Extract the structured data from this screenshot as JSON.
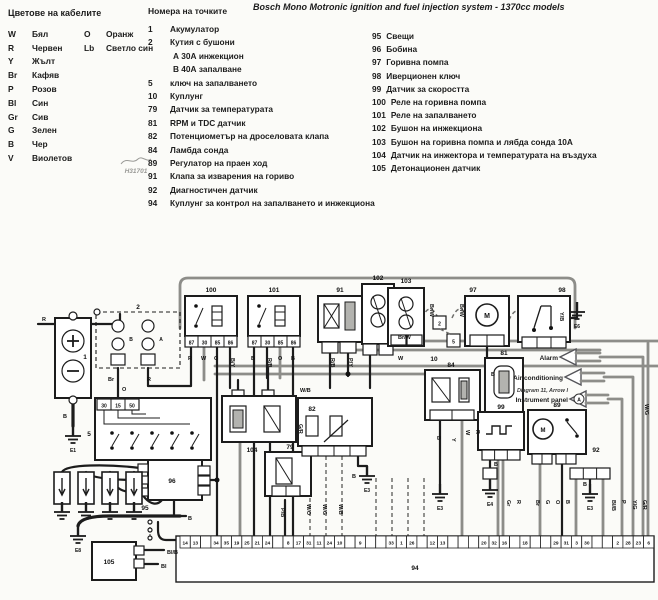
{
  "title": "Bosch Mono Motronic ignition and fuel injection system - 1370cc models",
  "watermark": "H31701",
  "wire_colors": {
    "header": "Цветове на кабелите",
    "rows": [
      {
        "code": "W",
        "name": "Бял",
        "code2": "O",
        "name2": "Оранж"
      },
      {
        "code": "R",
        "name": "Червен",
        "code2": "Lb",
        "name2": "Светло син"
      },
      {
        "code": "Y",
        "name": "Жълт"
      },
      {
        "code": "Br",
        "name": "Кафяв"
      },
      {
        "code": "P",
        "name": "Розов"
      },
      {
        "code": "Bl",
        "name": "Син"
      },
      {
        "code": "Gr",
        "name": "Сив"
      },
      {
        "code": "G",
        "name": "Зелен"
      },
      {
        "code": "B",
        "name": "Чер"
      },
      {
        "code": "V",
        "name": "Виолетов"
      }
    ]
  },
  "points": {
    "header": "Номера на точките",
    "items": [
      {
        "num": "1",
        "text": "Акумулатор"
      },
      {
        "num": "2",
        "text": "Кутия с бушони"
      },
      {
        "num": "",
        "text": "А 30А инжекцион",
        "indent": true
      },
      {
        "num": "",
        "text": "В 40А запалване",
        "indent": true
      },
      {
        "num": "5",
        "text": "ключ на запалването"
      },
      {
        "num": "10",
        "text": "Куплунг"
      },
      {
        "num": "79",
        "text": "Датчик за температурата"
      },
      {
        "num": "81",
        "text": "RPM и TDC датчик"
      },
      {
        "num": "82",
        "text": "Потенциометър на дроселовата клапа"
      },
      {
        "num": "84",
        "text": "Ламбда сонда"
      },
      {
        "num": "89",
        "text": "Регулатор на праен ход"
      },
      {
        "num": "91",
        "text": "Клапа за изварения на гориво"
      },
      {
        "num": "92",
        "text": "Диагностичен датчик"
      },
      {
        "num": "94",
        "text": "Куплунг за контрол на запалването и инжекциона"
      }
    ]
  },
  "points_right": {
    "items": [
      {
        "num": "95",
        "text": "Свещи"
      },
      {
        "num": "96",
        "text": "Бобина"
      },
      {
        "num": "97",
        "text": "Горивна помпа"
      },
      {
        "num": "98",
        "text": "Иверционен ключ"
      },
      {
        "num": "99",
        "text": "Датчик за скоростта"
      },
      {
        "num": "100",
        "text": "Реле на горивна помпа"
      },
      {
        "num": "101",
        "text": "Реле на запалването"
      },
      {
        "num": "102",
        "text": "Бушон на инжекциона"
      },
      {
        "num": "103",
        "text": "Бушон на горивна помпа и лябда сонда  10А"
      },
      {
        "num": "104",
        "text": "Датчик на инжектора и температурата на въздуха"
      },
      {
        "num": "105",
        "text": "Детонационен датчик"
      }
    ]
  },
  "diagram": {
    "labels": {
      "c1": "1",
      "c2": "2",
      "c5": "5",
      "c10": "10",
      "c79": "79",
      "c81": "81",
      "c82": "82",
      "c84": "84",
      "c89": "89",
      "c91": "91",
      "c92": "92",
      "c94": "94",
      "c95": "95",
      "c96": "96",
      "c97": "97",
      "c98": "98",
      "c99": "99",
      "c100": "100",
      "c101": "101",
      "c102": "102",
      "c103": "103",
      "c104": "104",
      "c105": "105",
      "m97": "M",
      "m89": "M",
      "fuse_b": "B",
      "fuse_a": "A",
      "conn2": "2",
      "conn5": "5"
    },
    "terminals": {
      "ign": [
        "30",
        "15",
        "50"
      ],
      "relay": [
        "87",
        "30",
        "85",
        "86"
      ]
    },
    "arrows": {
      "alarm": "Alarm",
      "ac": "Air conditioning",
      "note": "Diagram 11, Arrow I",
      "panel": "Instrument panel",
      "a": "A"
    },
    "wires": {
      "r_in": "R",
      "o_ign": "O",
      "fuse_br": "Br",
      "fuse_r": "R",
      "bat_b": "B",
      "r100_1": "R",
      "r100_2": "W",
      "r100_3": "O",
      "r100_4": "B/Y",
      "r101_1": "B",
      "r101_2": "R/B",
      "r101_3": "O",
      "r101_4": "B",
      "v91_1": "R/B",
      "v91_2": "P/Y",
      "brw_1": "Br/W",
      "w_1": "W",
      "brw_2": "Br/W",
      "brw_3": "Br/W",
      "b_97": "B",
      "yb_98": "Y/B",
      "wb_104": "W/B",
      "gr_104": "G/R",
      "pb_79": "P/B",
      "wo_82": "W/O",
      "wg_82": "W/G",
      "wb_82": "W/B",
      "b_82": "B",
      "b_96": "B",
      "blb_105": "Bl/B",
      "bl_105": "Bl",
      "b_99": "B",
      "gr_99": "Gr",
      "r_99": "R",
      "br_89": "Br",
      "g_89": "G",
      "o_89": "O",
      "b_89": "B",
      "b_92": "B",
      "blb_r": "Bl/B",
      "p_r": "P",
      "yg_r": "Y/G",
      "gr_r": "G/R",
      "wg_r": "W/G",
      "b_84": "B",
      "y_84": "Y",
      "w_81": "W",
      "r_81": "R"
    },
    "grounds": [
      {
        "label": "E1",
        "x": 73,
        "y": 208
      },
      {
        "label": "E8",
        "x": 78,
        "y": 308
      },
      {
        "label": "E3",
        "x": 367,
        "y": 248
      },
      {
        "label": "E3",
        "x": 440,
        "y": 266
      },
      {
        "label": "E4",
        "x": 490,
        "y": 262
      },
      {
        "label": "E3",
        "x": 590,
        "y": 266
      },
      {
        "label": "E6",
        "x": 577,
        "y": 84
      },
      {
        "label": "",
        "x": 62,
        "y": 284
      },
      {
        "label": "",
        "x": 86,
        "y": 284
      },
      {
        "label": "",
        "x": 110,
        "y": 284
      },
      {
        "label": "",
        "x": 134,
        "y": 284
      }
    ],
    "connector": {
      "label": "94",
      "pins": [
        "14",
        "13",
        "",
        "34",
        "35",
        "19",
        "25",
        "21",
        "24",
        "",
        "8",
        "17",
        "31",
        "11",
        "24",
        "10",
        "",
        "9",
        "",
        "",
        "33",
        "1",
        "26",
        "",
        "12",
        "13",
        "",
        "",
        "",
        "20",
        "32",
        "16",
        "",
        "18",
        "",
        "",
        "29",
        "31",
        "3",
        "30",
        "",
        "",
        "2",
        "28",
        "23",
        "6"
      ]
    }
  }
}
